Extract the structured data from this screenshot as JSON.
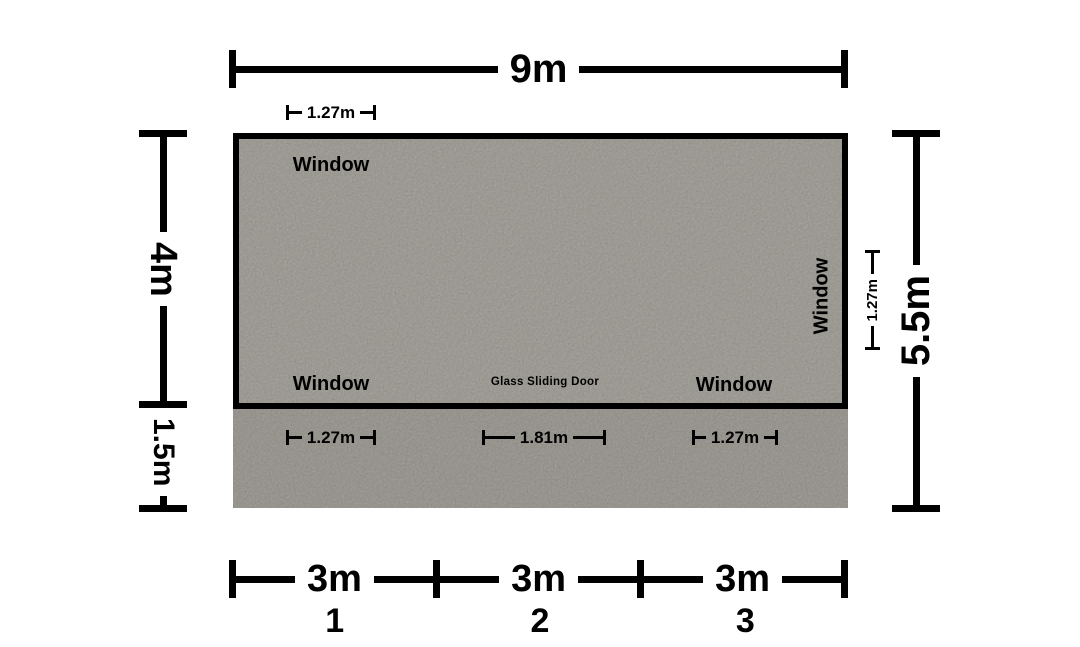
{
  "canvas": {
    "background": "#ffffff",
    "line_color": "#000000"
  },
  "room": {
    "fill": "#a09e97",
    "labels": {
      "window_top_left": "Window",
      "window_bottom_left": "Window",
      "door": "Glass Sliding Door",
      "window_bottom_right": "Window",
      "window_right": "Window"
    }
  },
  "patio": {
    "fill": "#99978f"
  },
  "dimensions": {
    "top_width": {
      "label": "9m"
    },
    "top_window_offset": {
      "label": "1.27m"
    },
    "left_upper": {
      "label": "4m"
    },
    "left_lower": {
      "label": "1.5m"
    },
    "right_total": {
      "label": "5.5m"
    },
    "right_window": {
      "label": "1.27m"
    },
    "patio_left_window": {
      "label": "1.27m"
    },
    "patio_door": {
      "label": "1.81m"
    },
    "patio_right_window": {
      "label": "1.27m"
    },
    "bottom_segments": [
      {
        "label": "3m",
        "number": "1"
      },
      {
        "label": "3m",
        "number": "2"
      },
      {
        "label": "3m",
        "number": "3"
      }
    ]
  }
}
